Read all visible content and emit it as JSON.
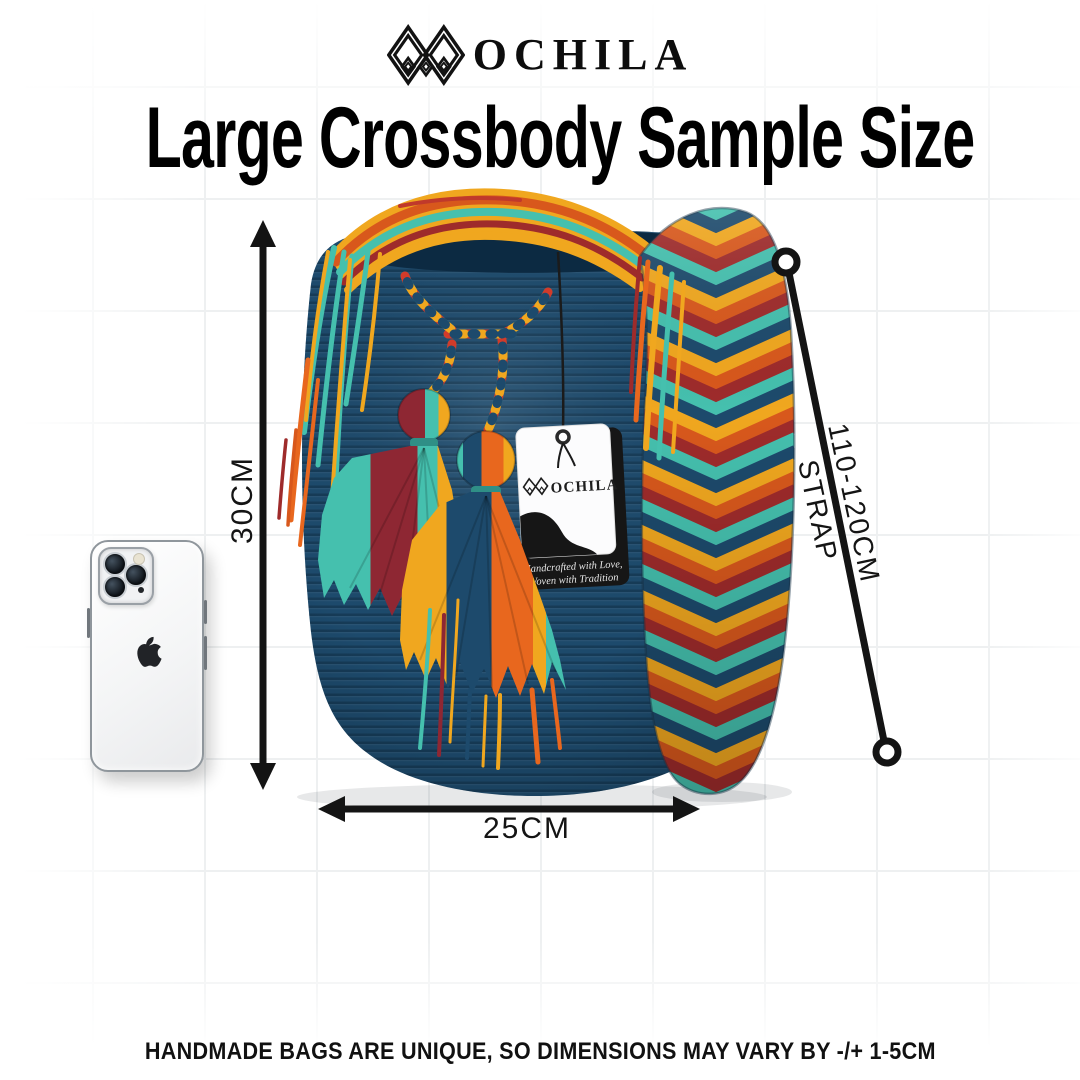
{
  "header": {
    "brand_text": "OCHILA",
    "brand_mark": "wayuu-m-monogram"
  },
  "title": "Large Crossbody Sample Size",
  "labels": {
    "height": "30CM",
    "width": "25CM",
    "strap_line1": "110-120CM",
    "strap_line2": "STRAP"
  },
  "hang_tag": {
    "brand_text": "OCHILA",
    "tagline_line1": "Handcrafted with Love,",
    "tagline_line2": "Woven with Tradition"
  },
  "footer": {
    "note": "HANDMADE BAGS ARE UNIQUE, SO DIMENSIONS MAY VARY BY -/+ 1-5CM"
  },
  "objects": {
    "bag": "blue wayuu crochet crossbody bag with tassels and chevron strap",
    "phone": "white iphone shown for scale"
  },
  "colors": {
    "bag_navy": "#1d4a6c",
    "teal": "#45c0ae",
    "gold": "#f0a71f",
    "orange": "#e8671e",
    "rust": "#d8581c",
    "maroon": "#8e2733",
    "ink": "#141414",
    "grid_line": "#eef0f1"
  }
}
